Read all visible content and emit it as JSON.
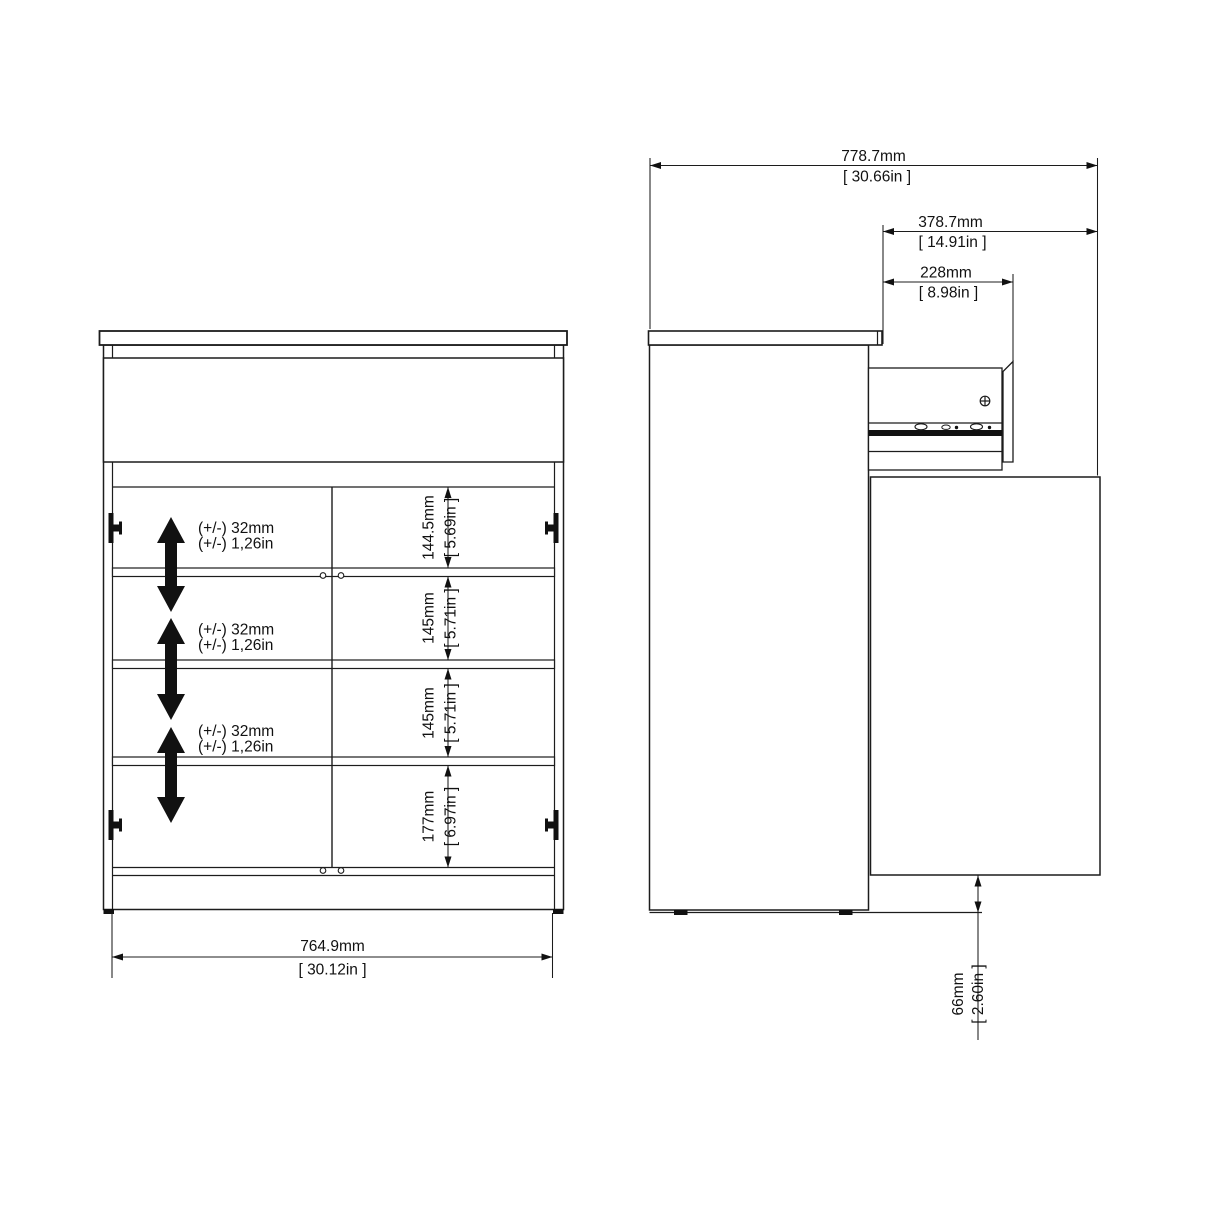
{
  "front_view": {
    "shelf_adjust": {
      "mm": "(+/-) 32mm",
      "inch": "(+/-) 1,26in"
    },
    "compartments": [
      {
        "mm": "144.5mm",
        "inch": "[ 5.69in ]"
      },
      {
        "mm": "145mm",
        "inch": "[ 5.71in ]"
      },
      {
        "mm": "145mm",
        "inch": "[ 5.71in ]"
      },
      {
        "mm": "177mm",
        "inch": "[ 6.97in ]"
      }
    ],
    "width": {
      "mm": "764.9mm",
      "inch": "[ 30.12in ]"
    }
  },
  "side_view": {
    "depth_total": {
      "mm": "778.7mm",
      "inch": "[ 30.66in ]"
    },
    "open_extension": {
      "mm": "378.7mm",
      "inch": "[ 14.91in ]"
    },
    "drawer_extension": {
      "mm": "228mm",
      "inch": "[ 8.98in ]"
    },
    "floor_clearance": {
      "mm": "66mm",
      "inch": "[ 2.60in ]"
    }
  },
  "colors": {
    "line": "#1c1c1c",
    "background": "#ffffff",
    "arrow_fill": "#111111"
  }
}
